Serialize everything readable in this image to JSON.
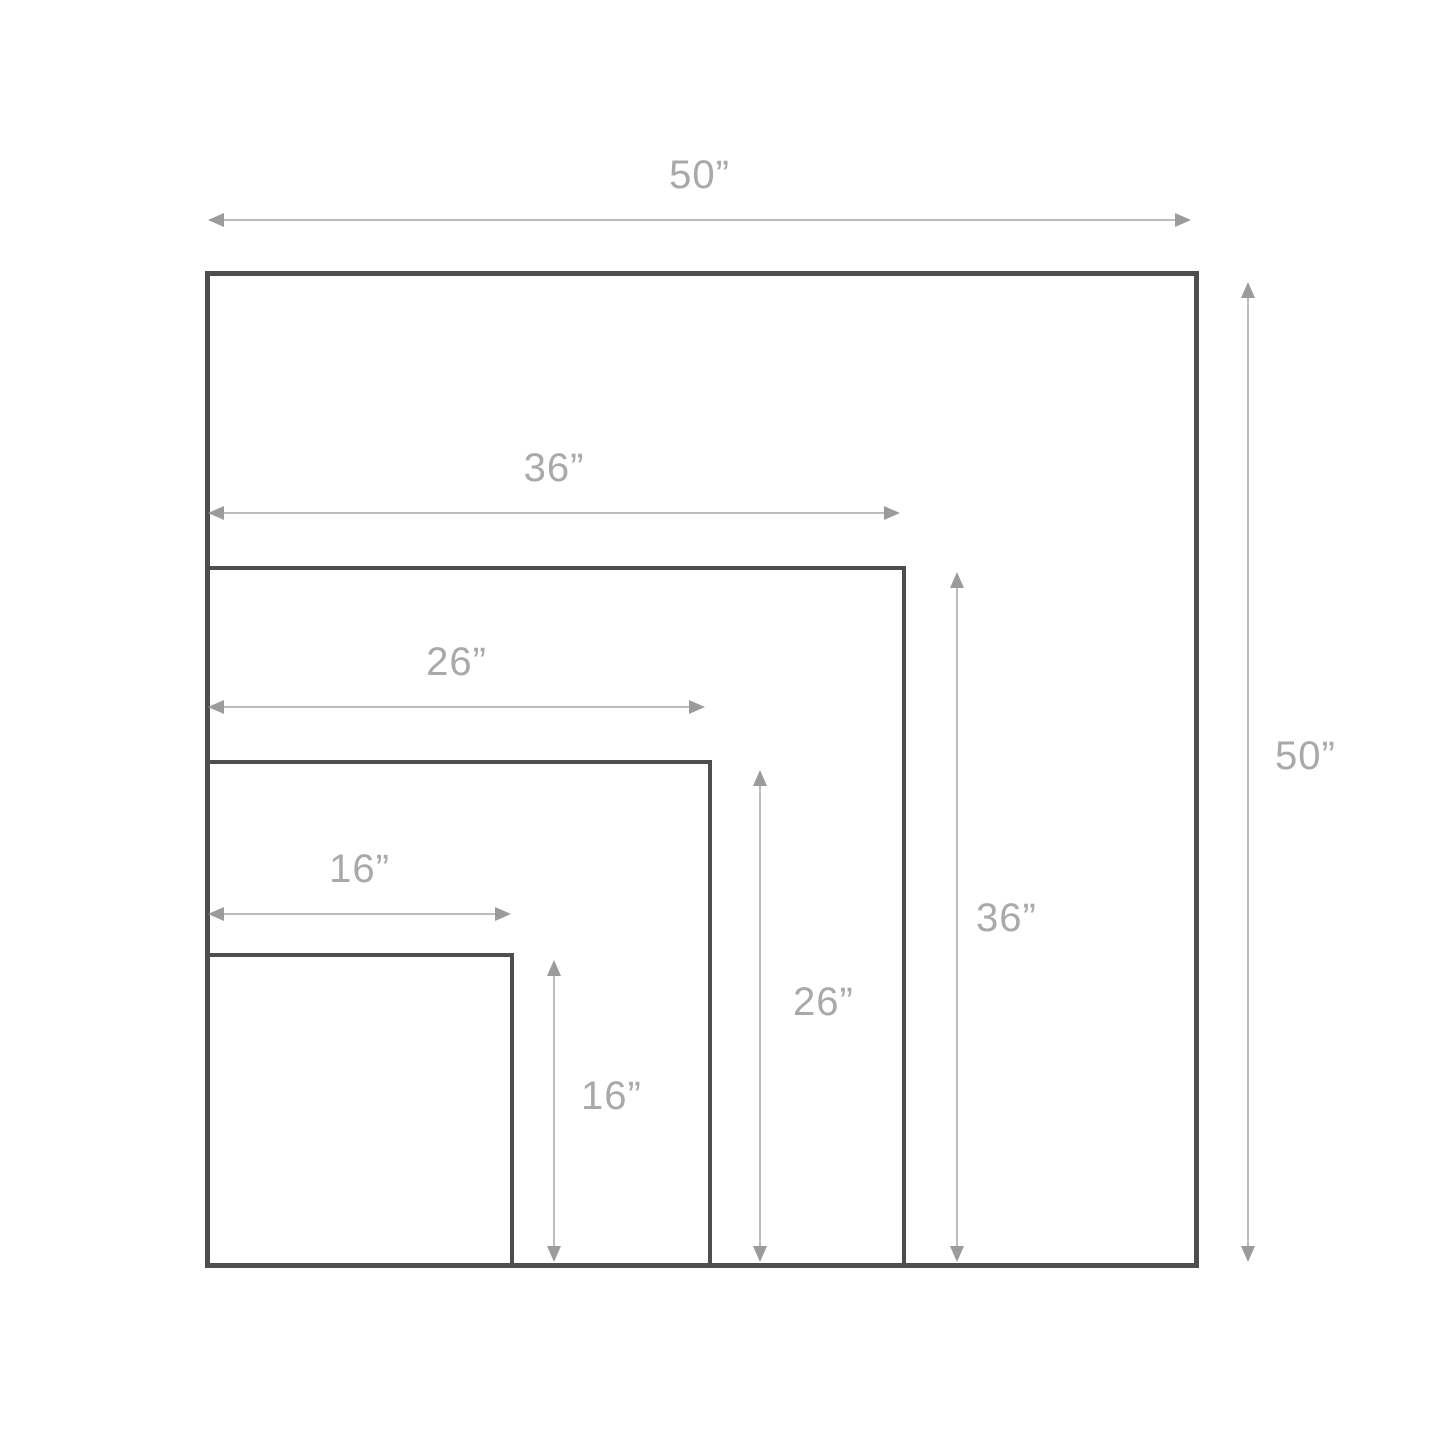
{
  "diagram": {
    "description": "Nested square size diagram with dimension arrows",
    "unit_suffix": "”",
    "sizes": [
      {
        "inches": 50,
        "label": "50”"
      },
      {
        "inches": 36,
        "label": "36”"
      },
      {
        "inches": 26,
        "label": "26”"
      },
      {
        "inches": 16,
        "label": "16”"
      }
    ],
    "colors": {
      "background": "#ffffff",
      "square_border": "#4e4e4e",
      "arrow_shaft": "#bcbcbc",
      "arrowhead": "#9b9b9b",
      "label_text": "#a9a9a9"
    }
  }
}
